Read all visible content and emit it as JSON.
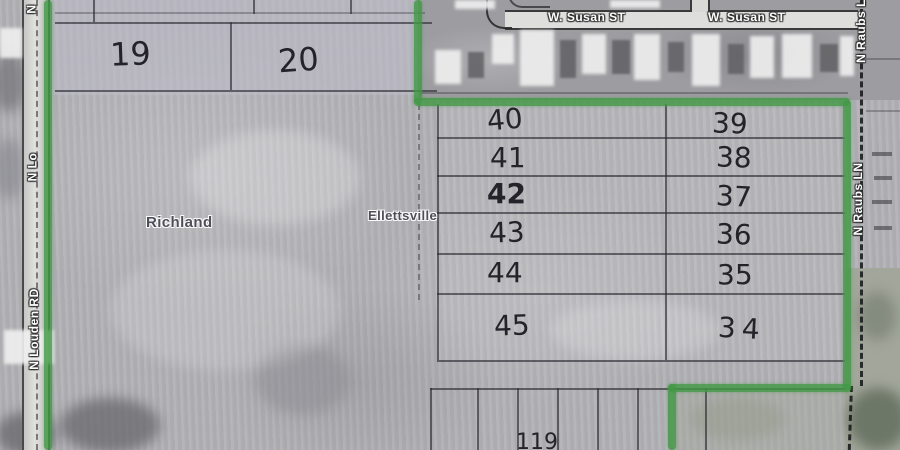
{
  "places": {
    "township": "Richland",
    "town": "Ellettsville"
  },
  "roads": {
    "louden": {
      "name": "N Louden RD",
      "fragment": "N Lo",
      "initial": "N"
    },
    "susan": {
      "labels": [
        "W. Susan ST",
        "W. Susan ST"
      ]
    },
    "raubs": {
      "name": "N Raubs LN",
      "fragment": "N Raubs L"
    }
  },
  "parcels": {
    "upper_left": [
      {
        "num": "19"
      },
      {
        "num": "20"
      }
    ],
    "grid": {
      "rows": [
        {
          "left": "40",
          "right": "39"
        },
        {
          "left": "41",
          "right": "38"
        },
        {
          "left": "42",
          "right": "37"
        },
        {
          "left": "43",
          "right": "36"
        },
        {
          "left": "44",
          "right": "35"
        },
        {
          "left": "45",
          "right": "34"
        }
      ]
    },
    "bottom_partial": "119"
  },
  "colors": {
    "boundary_green": "#429846",
    "map_base": "#b2b2b6",
    "handwriting": "#232329",
    "place_label": "#4e4e58",
    "road_label": "#ffffff"
  }
}
